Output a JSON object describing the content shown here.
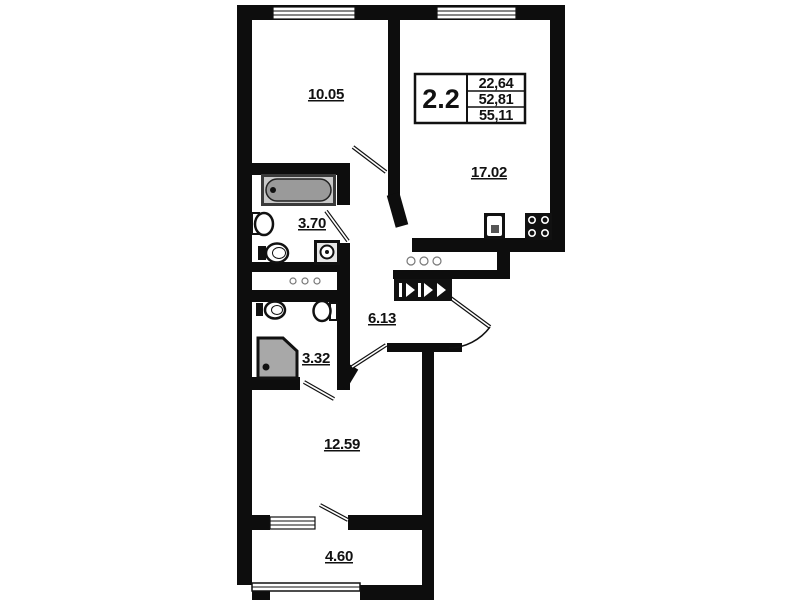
{
  "floorplan": {
    "unit": {
      "label": "2.2",
      "values": [
        "22,64",
        "52,81",
        "55,11"
      ]
    },
    "rooms": {
      "room_top_left": "10.05",
      "room_top_right": "17.02",
      "bathroom": "3.70",
      "hallway": "6.13",
      "wc": "3.32",
      "room_bottom": "12.59",
      "balcony": "4.60"
    },
    "colors": {
      "wall": "#0d0d0d",
      "fixture_gray": "#9a9a9a",
      "background": "#ffffff"
    },
    "icons": [
      "bathtub-icon",
      "toilet-icon",
      "sink-icon",
      "washing-machine-icon",
      "shower-icon",
      "kitchen-sink-icon",
      "stove-icon",
      "pipe-riser-icon",
      "vent-duct-icon",
      "window-icon",
      "door-swing-icon"
    ]
  }
}
